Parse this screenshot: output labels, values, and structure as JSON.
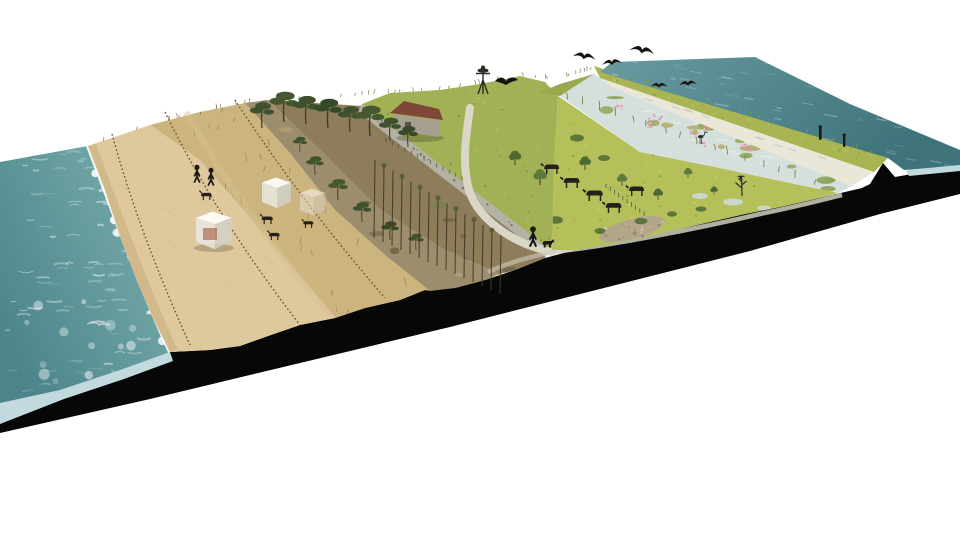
{
  "meta": {
    "kind": "landscape-section-perspective",
    "description": "Photomontage section-perspective of a coastal transect: sea, beach, foredunes with sand fences, dune scrub with bunkers and goats, pine woodland, grassland with barn, grazing meadow, freshwater marsh, bare sand flat, grass dike and open water, cut as a slab with a black terrain-profile face",
    "background": "#ffffff"
  },
  "palette": {
    "sea_deep": "#4b858b",
    "sea_light": "#7fb2b0",
    "sea_foam": "#f5f8f4",
    "sea_face": "#c2dade",
    "beach_dry": "#dfc89b",
    "beach_wet": "#c6a977",
    "sand_streak": "#c2a877",
    "dune_sand": "#cbb47e",
    "dune_tuft": "#857a47",
    "scrub_base": "#9c8d6d",
    "shrub": "#6b6147",
    "pine_canopy": "#3f512d",
    "pine_trunk": "#463828",
    "understory": "#8d7d5b",
    "wall_stone": "#b5b2a5",
    "hill_grass": "#a3b156",
    "hill_grass_light": "#c0c76d",
    "barn_roof": "#7e4737",
    "barn_wall": "#a79f90",
    "path": "#dbd7c6",
    "meadow": "#b5c05b",
    "bush": "#567038",
    "marsh_water": "#d5e0dc",
    "sedge": "#95a75a",
    "marsh_flower": "#e08ea6",
    "sand_flat": "#eae6d8",
    "dike_grass": "#a9b453",
    "water_deep": "#3f737c",
    "water_light": "#699ba1",
    "water_face": "#bfd9dc",
    "cut_black": "#070707",
    "dark_figure": "#1c1915",
    "animal": "#27201a"
  },
  "scene": {
    "zones": [
      {
        "id": "sea",
        "label": "sea with breaking waves"
      },
      {
        "id": "beach",
        "label": "sandy beach with surf line"
      },
      {
        "id": "foredune",
        "label": "foredunes with sand fences and walkers"
      },
      {
        "id": "dune-scrub",
        "label": "dune scrub with bunker blocks and goats"
      },
      {
        "id": "pine-wood",
        "label": "pine woodland on dune ridge"
      },
      {
        "id": "grass-hill",
        "label": "grass slope with stone wall, barn and nest pole"
      },
      {
        "id": "path",
        "label": "walking path with walker and dog"
      },
      {
        "id": "meadow",
        "label": "grazing meadow with cattle and shell patch"
      },
      {
        "id": "marsh",
        "label": "freshwater marsh with flowering plants and heron"
      },
      {
        "id": "sand-flat",
        "label": "bare sand flat"
      },
      {
        "id": "dike",
        "label": "grass dike with standing figures"
      },
      {
        "id": "outer-water",
        "label": "open water behind the dike"
      },
      {
        "id": "section-cut",
        "label": "black terrain profile of the cut slab"
      }
    ],
    "fauna": {
      "gulls_flying": 5,
      "goose_flying": 1,
      "heron": 1,
      "perched_birds": 2,
      "goats": 4,
      "cattle": 5,
      "dog": 1,
      "figures_on_dike": 2
    },
    "people": {
      "dune_walkers": 2,
      "path_walker": 1
    },
    "structures": [
      "sand-fences",
      "bunker-blocks",
      "stone-wall",
      "barn",
      "nest-pole",
      "dead-tree-perch",
      "field-fences"
    ]
  }
}
